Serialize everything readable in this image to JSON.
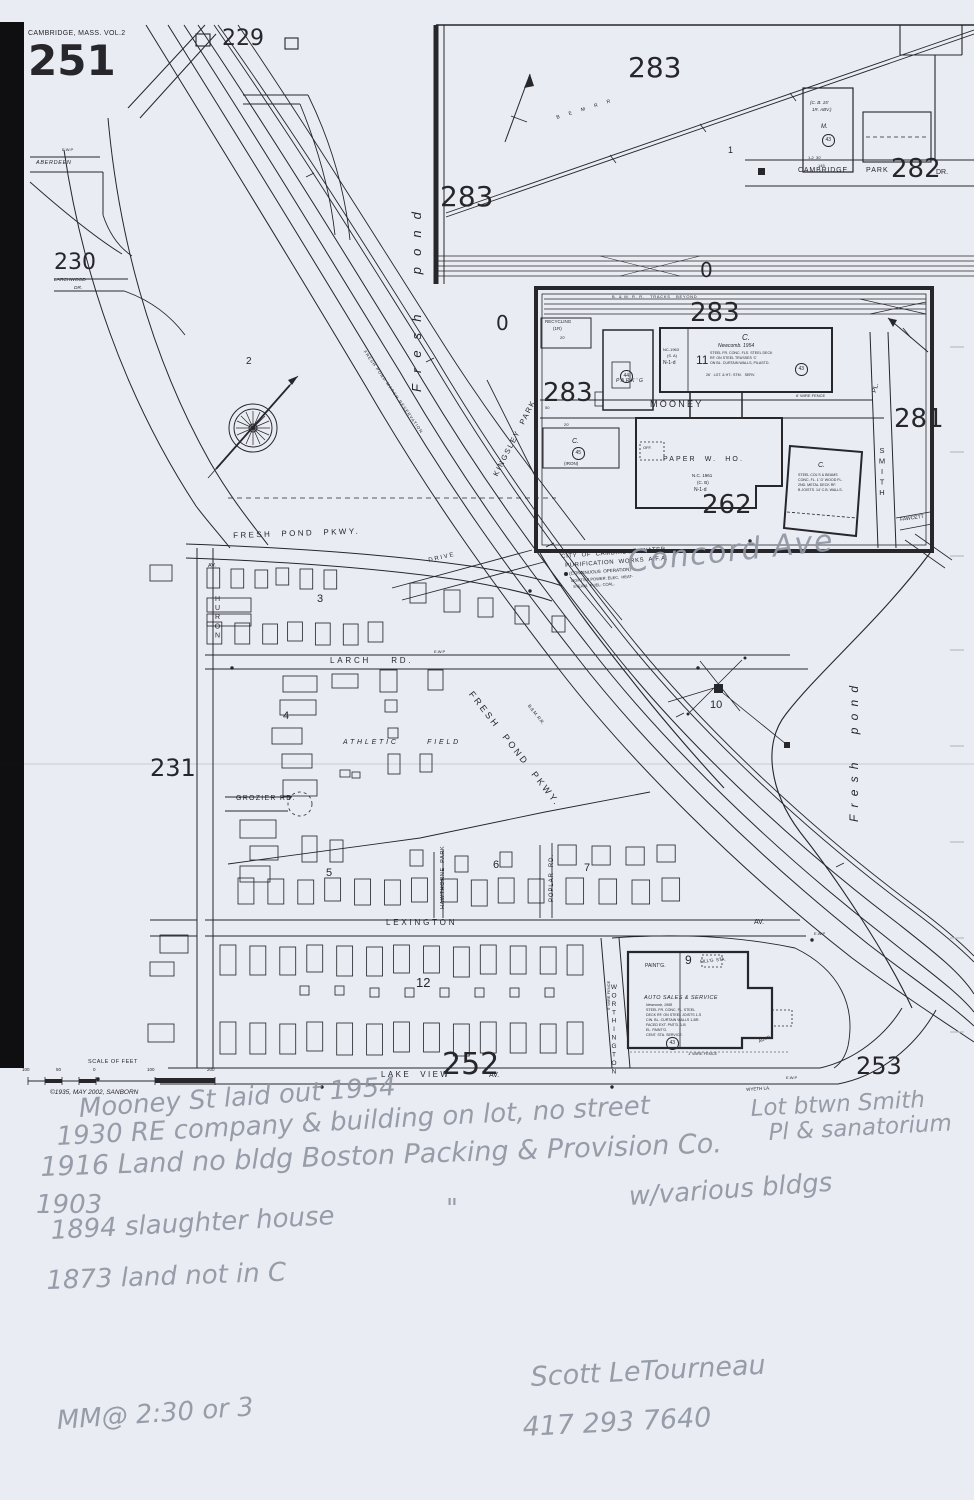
{
  "page": {
    "kind": "scanned Sanborn fire insurance map sheet with pencil annotations",
    "paper_color": "#e9edf3",
    "ink_color": "#26262b",
    "pencil_color": "#8f96a2"
  },
  "labels": [
    {
      "n": "volume-title",
      "t": "CAMBRIDGE, MASS. VOL.2",
      "x": 28,
      "y": 30,
      "fs": 7,
      "ls": 0.05
    },
    {
      "n": "sheet-number",
      "t": "251",
      "x": 28,
      "y": 40,
      "fs": 42,
      "w": 700,
      "big": true
    },
    {
      "n": "plate-229",
      "t": "229",
      "x": 222,
      "y": 28,
      "fs": 22,
      "big": true
    },
    {
      "n": "plate-230",
      "t": "230",
      "x": 54,
      "y": 252,
      "fs": 22,
      "big": true
    },
    {
      "n": "plate-231",
      "t": "231",
      "x": 150,
      "y": 756,
      "fs": 24,
      "big": true
    },
    {
      "n": "plate-252",
      "t": "252",
      "x": 442,
      "y": 1050,
      "fs": 30,
      "big": true
    },
    {
      "n": "plate-253",
      "t": "253",
      "x": 856,
      "y": 1054,
      "fs": 24,
      "big": true
    },
    {
      "n": "plate-262",
      "t": "262",
      "x": 702,
      "y": 492,
      "fs": 26,
      "big": true
    },
    {
      "n": "plate-281",
      "t": "281",
      "x": 894,
      "y": 406,
      "fs": 26,
      "big": true
    },
    {
      "n": "plate-282",
      "t": "282",
      "x": 891,
      "y": 156,
      "fs": 26,
      "big": true
    },
    {
      "n": "plate-283-top",
      "t": "283",
      "x": 628,
      "y": 54,
      "fs": 28,
      "big": true
    },
    {
      "n": "plate-283-left",
      "t": "283",
      "x": 440,
      "y": 183,
      "fs": 28,
      "big": true
    },
    {
      "n": "plate-283-inset-top",
      "t": "283",
      "x": 690,
      "y": 300,
      "fs": 26,
      "big": true
    },
    {
      "n": "plate-283-inset-left",
      "t": "283",
      "x": 543,
      "y": 380,
      "fs": 26,
      "big": true
    },
    {
      "n": "zero-mark-a",
      "t": "0",
      "x": 496,
      "y": 313,
      "fs": 20,
      "big": true
    },
    {
      "n": "zero-mark-b",
      "t": "0",
      "x": 700,
      "y": 260,
      "fs": 20,
      "big": true
    },
    {
      "n": "lot-number-1",
      "t": "1",
      "x": 728,
      "y": 146,
      "fs": 9
    },
    {
      "n": "block-2",
      "t": "2",
      "x": 246,
      "y": 357,
      "fs": 10
    },
    {
      "n": "block-3",
      "t": "3",
      "x": 317,
      "y": 594,
      "fs": 11
    },
    {
      "n": "block-4",
      "t": "4",
      "x": 283,
      "y": 711,
      "fs": 11
    },
    {
      "n": "block-5",
      "t": "5",
      "x": 326,
      "y": 868,
      "fs": 11
    },
    {
      "n": "block-6",
      "t": "6",
      "x": 493,
      "y": 860,
      "fs": 11
    },
    {
      "n": "block-7",
      "t": "7",
      "x": 584,
      "y": 863,
      "fs": 11
    },
    {
      "n": "block-9",
      "t": "9",
      "x": 685,
      "y": 954,
      "fs": 12
    },
    {
      "n": "block-10",
      "t": "10",
      "x": 710,
      "y": 700,
      "fs": 11
    },
    {
      "n": "block-11",
      "t": "11",
      "x": 696,
      "y": 354,
      "fs": 12
    },
    {
      "n": "block-12",
      "t": "12",
      "x": 416,
      "y": 976,
      "fs": 13
    },
    {
      "n": "street-aberdeen",
      "t": "ABERDEEN",
      "x": 36,
      "y": 161,
      "fs": 5.5,
      "it": true,
      "ls": 0.12
    },
    {
      "n": "street-larchwood",
      "t": "LARCHWOOD",
      "x": 54,
      "y": 279,
      "fs": 4.8,
      "it": true
    },
    {
      "n": "street-larchwood-dr",
      "t": "DR.",
      "x": 74,
      "y": 287,
      "fs": 4.8,
      "it": true
    },
    {
      "n": "street-fresh-pond-pkwy",
      "t": "FRESH  POND  PKWY.",
      "x": 233,
      "y": 532,
      "fs": 8,
      "ls": 0.3,
      "rot": -2
    },
    {
      "n": "street-drive",
      "t": "DRIVE",
      "x": 428,
      "y": 558,
      "fs": 6,
      "ls": 0.3,
      "rot": -13
    },
    {
      "n": "street-huron-av-suffix",
      "t": "AV.",
      "x": 208,
      "y": 564,
      "fs": 5.5
    },
    {
      "n": "street-huron",
      "t": "HURON",
      "x": 214,
      "y": 596,
      "fs": 7,
      "ls": 0.3,
      "stack": true
    },
    {
      "n": "street-larch-rd",
      "t": "LARCH    RD.",
      "x": 330,
      "y": 657,
      "fs": 8,
      "ls": 0.35
    },
    {
      "n": "street-grozier-rd",
      "t": "GROZIER RD.",
      "x": 236,
      "y": 795,
      "fs": 7,
      "ls": 0.18
    },
    {
      "n": "street-lexington",
      "t": "LEXINGTON",
      "x": 386,
      "y": 919,
      "fs": 8,
      "ls": 0.35
    },
    {
      "n": "street-lexington-av-suffix",
      "t": "AV.",
      "x": 754,
      "y": 919,
      "fs": 7
    },
    {
      "n": "street-lake-view",
      "t": "LAKE  VIEW",
      "x": 381,
      "y": 1071,
      "fs": 8,
      "ls": 0.3
    },
    {
      "n": "street-lake-view-av-suffix",
      "t": "AV.",
      "x": 489,
      "y": 1072,
      "fs": 7
    },
    {
      "n": "street-worthington",
      "t": "WORTHINGTON",
      "x": 610,
      "y": 984,
      "fs": 6.5,
      "ls": 0.22,
      "stack": true
    },
    {
      "n": "street-poplar-rd",
      "t": "POPLAR  RD.",
      "x": 549,
      "y": 902,
      "fs": 6,
      "ls": 0.15,
      "rot": -90
    },
    {
      "n": "street-hawthorne-park",
      "t": "HAWTHORNE  PARK",
      "x": 441,
      "y": 909,
      "fs": 5.5,
      "ls": 0.12,
      "rot": -90
    },
    {
      "n": "street-kingsley-park",
      "t": "KINGSLEY  PARK",
      "x": 492,
      "y": 474,
      "fs": 7.5,
      "ls": 0.22,
      "rot": -63
    },
    {
      "n": "street-cambridge",
      "t": "CAMBRIDGE",
      "x": 798,
      "y": 167,
      "fs": 7,
      "ls": 0.12
    },
    {
      "n": "street-park",
      "t": "PARK",
      "x": 866,
      "y": 167,
      "fs": 7,
      "ls": 0.15
    },
    {
      "n": "street-cambridge-dr-suffix",
      "t": "DR.",
      "x": 936,
      "y": 169,
      "fs": 7
    },
    {
      "n": "street-mooney",
      "t": "MOONEY",
      "x": 650,
      "y": 400,
      "fs": 9,
      "ls": 0.25
    },
    {
      "n": "street-smith-pl-suffix",
      "t": "PL.",
      "x": 872,
      "y": 392,
      "fs": 6.5,
      "rot": -75
    },
    {
      "n": "street-smith",
      "t": "SMITH",
      "x": 878,
      "y": 446,
      "fs": 7.5,
      "ls": 0.2,
      "stack": true
    },
    {
      "n": "street-fawcett",
      "t": "FAWCETT",
      "x": 900,
      "y": 518,
      "fs": 5,
      "rot": -8
    },
    {
      "n": "street-wyeth-la",
      "t": "WYETH LA.",
      "x": 746,
      "y": 1088,
      "fs": 4.5,
      "rot": -4
    },
    {
      "n": "street-fresh-pond-pkwy-diagonal",
      "t": "FRESH  POND  PKWY.",
      "x": 474,
      "y": 690,
      "fs": 9,
      "ls": 0.3,
      "rot": 52
    },
    {
      "n": "water-fresh-pond-left",
      "t": "Fresh  pond",
      "x": 410,
      "y": 392,
      "fs": 13,
      "it": true,
      "ls": 0.85,
      "rot": -90
    },
    {
      "n": "water-fresh-pond-right",
      "t": "Fresh  pond",
      "x": 848,
      "y": 822,
      "fs": 12,
      "it": true,
      "ls": 0.6,
      "rot": -90
    },
    {
      "n": "railroad-bm-inset",
      "t": "B  E  M  R  R",
      "x": 556,
      "y": 116,
      "fs": 5,
      "ls": 0.45,
      "rot": -17
    },
    {
      "n": "railroad-bm-main",
      "t": "B.& M. R.R.",
      "x": 530,
      "y": 704,
      "fs": 4.5,
      "rot": 52
    },
    {
      "n": "railroad-tracks-beyond",
      "t": "B. & M. R. R.   TRACKS   BEYOND",
      "x": 612,
      "y": 295,
      "fs": 4,
      "ls": 0.18
    },
    {
      "n": "reservation-note",
      "t": "FRESH POND MARSH RESERVATION",
      "x": 366,
      "y": 350,
      "fs": 4.2,
      "ls": 0.22,
      "rot": 55
    },
    {
      "n": "waterworks-line1",
      "t": "CITY  OF  CAMBRIDGE  WATER",
      "x": 561,
      "y": 554,
      "fs": 6,
      "ls": 0.1,
      "rot": -4
    },
    {
      "n": "waterworks-line2",
      "t": "PURIFICATION  WORKS  A.F.A.",
      "x": 565,
      "y": 563,
      "fs": 6,
      "ls": 0.1,
      "rot": -4
    },
    {
      "n": "waterworks-line3",
      "t": "(CONTINUOUS  OPERATION)",
      "x": 569,
      "y": 572,
      "fs": 4.5,
      "rot": -4
    },
    {
      "n": "waterworks-line4",
      "t": "LIGHTS & POWER: ELEC.  HEAT-",
      "x": 571,
      "y": 579,
      "fs": 4,
      "rot": -4
    },
    {
      "n": "waterworks-line5",
      "t": "STEAM,  FUEL: COAL.",
      "x": 573,
      "y": 585,
      "fs": 4,
      "rot": -4
    },
    {
      "n": "athletic-field",
      "t": "ATHLETIC      FIELD",
      "x": 343,
      "y": 739,
      "fs": 7,
      "it": true,
      "ls": 0.4
    },
    {
      "n": "recycling-line1",
      "t": "RECYCLING",
      "x": 545,
      "y": 320,
      "fs": 4.5
    },
    {
      "n": "recycling-line2",
      "t": "(1R)",
      "x": 553,
      "y": 327,
      "fs": 4.5
    },
    {
      "n": "recycling-line3",
      "t": "20'",
      "x": 560,
      "y": 336,
      "fs": 4
    },
    {
      "n": "parking-note",
      "t": "PARK'G",
      "x": 616,
      "y": 379,
      "fs": 5,
      "it": true,
      "ls": 0.35
    },
    {
      "n": "newcomb-class",
      "t": "C.",
      "x": 742,
      "y": 334,
      "fs": 8,
      "it": true
    },
    {
      "n": "newcomb-name",
      "t": "Newcomb. 1954",
      "x": 718,
      "y": 344,
      "fs": 5,
      "it": true
    },
    {
      "n": "newcomb-spec1",
      "t": "STEEL FR. CONC. FLS. STEEL DECK",
      "x": 710,
      "y": 352,
      "fs": 3.6
    },
    {
      "n": "newcomb-spec2",
      "t": "RF. ON STEEL TRUSSES 'C'",
      "x": 710,
      "y": 357,
      "fs": 3.6
    },
    {
      "n": "newcomb-spec3",
      "t": "ON BL. CURTAIN WALLS, PILASTD.",
      "x": 710,
      "y": 362,
      "fs": 3.6
    },
    {
      "n": "newcomb-spec4",
      "t": "26'   LGT. & HT.: STM.   SERV.",
      "x": 706,
      "y": 374,
      "fs": 3.6
    },
    {
      "n": "newcomb-annex1",
      "t": "NC-1963",
      "x": 663,
      "y": 348,
      "fs": 4
    },
    {
      "n": "newcomb-annex2",
      "t": "(S. A)",
      "x": 667,
      "y": 354,
      "fs": 4
    },
    {
      "n": "newcomb-annex3",
      "t": "N-1-d",
      "x": 663,
      "y": 361,
      "fs": 5
    },
    {
      "n": "paper-warehouse",
      "t": "PAPER  W.  HO.",
      "x": 663,
      "y": 456,
      "fs": 7,
      "ls": 0.3
    },
    {
      "n": "paper-warehouse-year",
      "t": "N.C. 1961",
      "x": 692,
      "y": 474,
      "fs": 4.5
    },
    {
      "n": "paper-warehouse-const",
      "t": "(C. B)",
      "x": 697,
      "y": 481,
      "fs": 4.5
    },
    {
      "n": "paper-warehouse-code",
      "t": "N-1-d",
      "x": 694,
      "y": 488,
      "fs": 5
    },
    {
      "n": "paper-warehouse-office",
      "t": "OFF.",
      "x": 643,
      "y": 446,
      "fs": 4
    },
    {
      "n": "iron-bldg-dim",
      "t": "20'",
      "x": 564,
      "y": 423,
      "fs": 4
    },
    {
      "n": "iron-bldg-class",
      "t": "C.",
      "x": 572,
      "y": 438,
      "fs": 7,
      "it": true
    },
    {
      "n": "iron-bldg-note",
      "t": "(IRON)",
      "x": 564,
      "y": 462,
      "fs": 4.5
    },
    {
      "n": "steel-bldg-class",
      "t": "C.",
      "x": 818,
      "y": 462,
      "fs": 7,
      "it": true
    },
    {
      "n": "steel-bldg-spec1",
      "t": "STEEL COL'S & BEAMS",
      "x": 798,
      "y": 474,
      "fs": 3.6
    },
    {
      "n": "steel-bldg-spec2",
      "t": "CONC. FL. 1' D' WOOD FL.",
      "x": 798,
      "y": 479,
      "fs": 3.6
    },
    {
      "n": "steel-bldg-spec3",
      "t": "2ND. METAL DECK RF.",
      "x": 798,
      "y": 484,
      "fs": 3.6
    },
    {
      "n": "steel-bldg-spec4",
      "t": "B JOISTS. 14' C.B. WALLS.",
      "x": 798,
      "y": 489,
      "fs": 3.6
    },
    {
      "n": "fence-6ft",
      "t": "6' WIRE FENCE",
      "x": 796,
      "y": 394,
      "fs": 4
    },
    {
      "n": "fence-1ft",
      "t": "1' WIRE FENCE",
      "x": 688,
      "y": 1052,
      "fs": 4
    },
    {
      "n": "fence-5ft",
      "t": "5' WIRE FENCE",
      "x": 607,
      "y": 1010,
      "fs": 4,
      "rot": -90
    },
    {
      "n": "mooney-width",
      "t": "50",
      "x": 545,
      "y": 406,
      "fs": 4
    },
    {
      "n": "cb-bldg-line1",
      "t": "(C. B. 15'",
      "x": 810,
      "y": 101,
      "fs": 4.5,
      "it": true
    },
    {
      "n": "cb-bldg-line2",
      "t": "1R. ABV.)",
      "x": 812,
      "y": 108,
      "fs": 4.5,
      "it": true
    },
    {
      "n": "cb-bldg-m",
      "t": "M.",
      "x": 821,
      "y": 124,
      "fs": 6,
      "it": true
    },
    {
      "n": "cb-bldg-dim1",
      "t": "1-2  30'",
      "x": 808,
      "y": 156,
      "fs": 4
    },
    {
      "n": "cb-bldg-dim2",
      "t": "145",
      "x": 818,
      "y": 164,
      "fs": 4
    },
    {
      "n": "auto-sales-title",
      "t": "AUTO SALES & SERVICE",
      "x": 644,
      "y": 996,
      "fs": 5.5,
      "it": true,
      "ls": 0.08
    },
    {
      "n": "auto-sales-year",
      "t": "Newcomb, 1958",
      "x": 646,
      "y": 1004,
      "fs": 3.6,
      "it": true
    },
    {
      "n": "auto-sales-spec1",
      "t": "STEEL FR. CONC. FL. STEEL",
      "x": 646,
      "y": 1009,
      "fs": 3.6
    },
    {
      "n": "auto-sales-spec2",
      "t": "DECK RF. ON STEEL JOISTS 1-S",
      "x": 646,
      "y": 1014,
      "fs": 3.6
    },
    {
      "n": "auto-sales-spec3",
      "t": "CIN. BL. CURTAIN WALLS 1-BR.",
      "x": 646,
      "y": 1019,
      "fs": 3.6
    },
    {
      "n": "auto-sales-spec4",
      "t": "FACED EXT. PNT'D. 1-B",
      "x": 646,
      "y": 1024,
      "fs": 3.6
    },
    {
      "n": "auto-sales-spec5",
      "t": "EL. PAINT'G.",
      "x": 646,
      "y": 1029,
      "fs": 3.6
    },
    {
      "n": "auto-sales-spec6",
      "t": "CENT. STA. SERVICE.",
      "x": 646,
      "y": 1034,
      "fs": 3.6
    },
    {
      "n": "painting-note",
      "t": "PAINT'G.",
      "x": 645,
      "y": 964,
      "fs": 5
    },
    {
      "n": "filling-station-note",
      "t": "FILL'G  STA.",
      "x": 700,
      "y": 960,
      "fs": 4.5,
      "rot": -6
    },
    {
      "n": "auto-road-note",
      "t": "AUTO",
      "x": 758,
      "y": 1040,
      "fs": 4.5,
      "rot": -22
    },
    {
      "n": "scale-title",
      "t": "SCALE OF FEET",
      "x": 88,
      "y": 1060,
      "fs": 5.5,
      "ls": 0.1
    },
    {
      "n": "scale-100-left",
      "t": "100",
      "x": 22,
      "y": 1068,
      "fs": 4.5
    },
    {
      "n": "scale-50",
      "t": "50",
      "x": 56,
      "y": 1068,
      "fs": 4.5
    },
    {
      "n": "scale-0",
      "t": "0",
      "x": 93,
      "y": 1068,
      "fs": 4.5
    },
    {
      "n": "scale-100-right",
      "t": "100",
      "x": 147,
      "y": 1068,
      "fs": 4.5
    },
    {
      "n": "scale-200",
      "t": "200",
      "x": 207,
      "y": 1068,
      "fs": 4.5
    },
    {
      "n": "copyright-stamp",
      "t": "©1935, MAY 2002, SANBORN",
      "x": 50,
      "y": 1090,
      "fs": 6.5,
      "it": true
    },
    {
      "n": "ewp-label-1",
      "t": "E.W.P",
      "x": 62,
      "y": 148,
      "fs": 4
    },
    {
      "n": "ewp-label-2",
      "t": "E.W.P",
      "x": 434,
      "y": 650,
      "fs": 4
    },
    {
      "n": "ewp-label-3",
      "t": "E.W.P",
      "x": 814,
      "y": 932,
      "fs": 4
    },
    {
      "n": "ewp-label-4",
      "t": "E.W.P",
      "x": 786,
      "y": 1076,
      "fs": 4
    },
    {
      "n": "pencil-concord-ave",
      "t": "Concord Ave",
      "x": 626,
      "y": 548,
      "fs": 30,
      "hand": true,
      "rot": -6,
      "ls": 0.05
    },
    {
      "n": "pencil-note-mooney",
      "t": "Mooney St laid out 1954",
      "x": 78,
      "y": 1096,
      "fs": 26,
      "hand": true,
      "rot": -4
    },
    {
      "n": "pencil-note-1930",
      "t": "1930 RE company & building on lot, no street",
      "x": 56,
      "y": 1124,
      "fs": 26,
      "hand": true,
      "rot": -3
    },
    {
      "n": "pencil-note-1916",
      "t": "1916 Land no bldg Boston Packing & Provision Co.",
      "x": 40,
      "y": 1154,
      "fs": 27,
      "hand": true,
      "rot": -2
    },
    {
      "n": "pencil-note-1903",
      "t": "1903",
      "x": 36,
      "y": 1192,
      "fs": 26,
      "hand": true
    },
    {
      "n": "pencil-ditto-mark",
      "t": "\"",
      "x": 446,
      "y": 1196,
      "fs": 26,
      "hand": true
    },
    {
      "n": "pencil-note-various",
      "t": "w/various bldgs",
      "x": 628,
      "y": 1184,
      "fs": 26,
      "hand": true,
      "rot": -4
    },
    {
      "n": "pencil-note-1894",
      "t": "1894 slaughter house",
      "x": 50,
      "y": 1218,
      "fs": 26,
      "hand": true,
      "rot": -3
    },
    {
      "n": "pencil-note-1873",
      "t": "1873 land not in C",
      "x": 46,
      "y": 1268,
      "fs": 26,
      "hand": true,
      "rot": -2
    },
    {
      "n": "pencil-lot-note-line1",
      "t": "Lot btwn Smith",
      "x": 750,
      "y": 1098,
      "fs": 23,
      "hand": true,
      "rot": -3
    },
    {
      "n": "pencil-lot-note-line2",
      "t": "Pl & sanatorium",
      "x": 768,
      "y": 1122,
      "fs": 23,
      "hand": true,
      "rot": -3
    },
    {
      "n": "pencil-signature",
      "t": "Scott LeTourneau",
      "x": 530,
      "y": 1364,
      "fs": 27,
      "hand": true,
      "rot": -3
    },
    {
      "n": "pencil-phone",
      "t": "417 293 7640",
      "x": 522,
      "y": 1414,
      "fs": 27,
      "hand": true,
      "rot": -3
    },
    {
      "n": "pencil-meeting-note",
      "t": "MM@ 2:30 or 3",
      "x": 56,
      "y": 1408,
      "fs": 26,
      "hand": true,
      "rot": -4
    },
    {
      "n": "circled-number-43-cambridge-park",
      "t": "43",
      "x": 822,
      "y": 134,
      "fs": 5,
      "circ": true
    },
    {
      "n": "circled-number-43-newcomb",
      "t": "43",
      "x": 795,
      "y": 363,
      "fs": 5,
      "circ": true
    },
    {
      "n": "circled-number-44",
      "t": "44",
      "x": 620,
      "y": 370,
      "fs": 5,
      "circ": true
    },
    {
      "n": "circled-number-45",
      "t": "45",
      "x": 572,
      "y": 447,
      "fs": 5,
      "circ": true
    },
    {
      "n": "circled-number-43-auto",
      "t": "43",
      "x": 666,
      "y": 1037,
      "fs": 5,
      "circ": true
    }
  ]
}
